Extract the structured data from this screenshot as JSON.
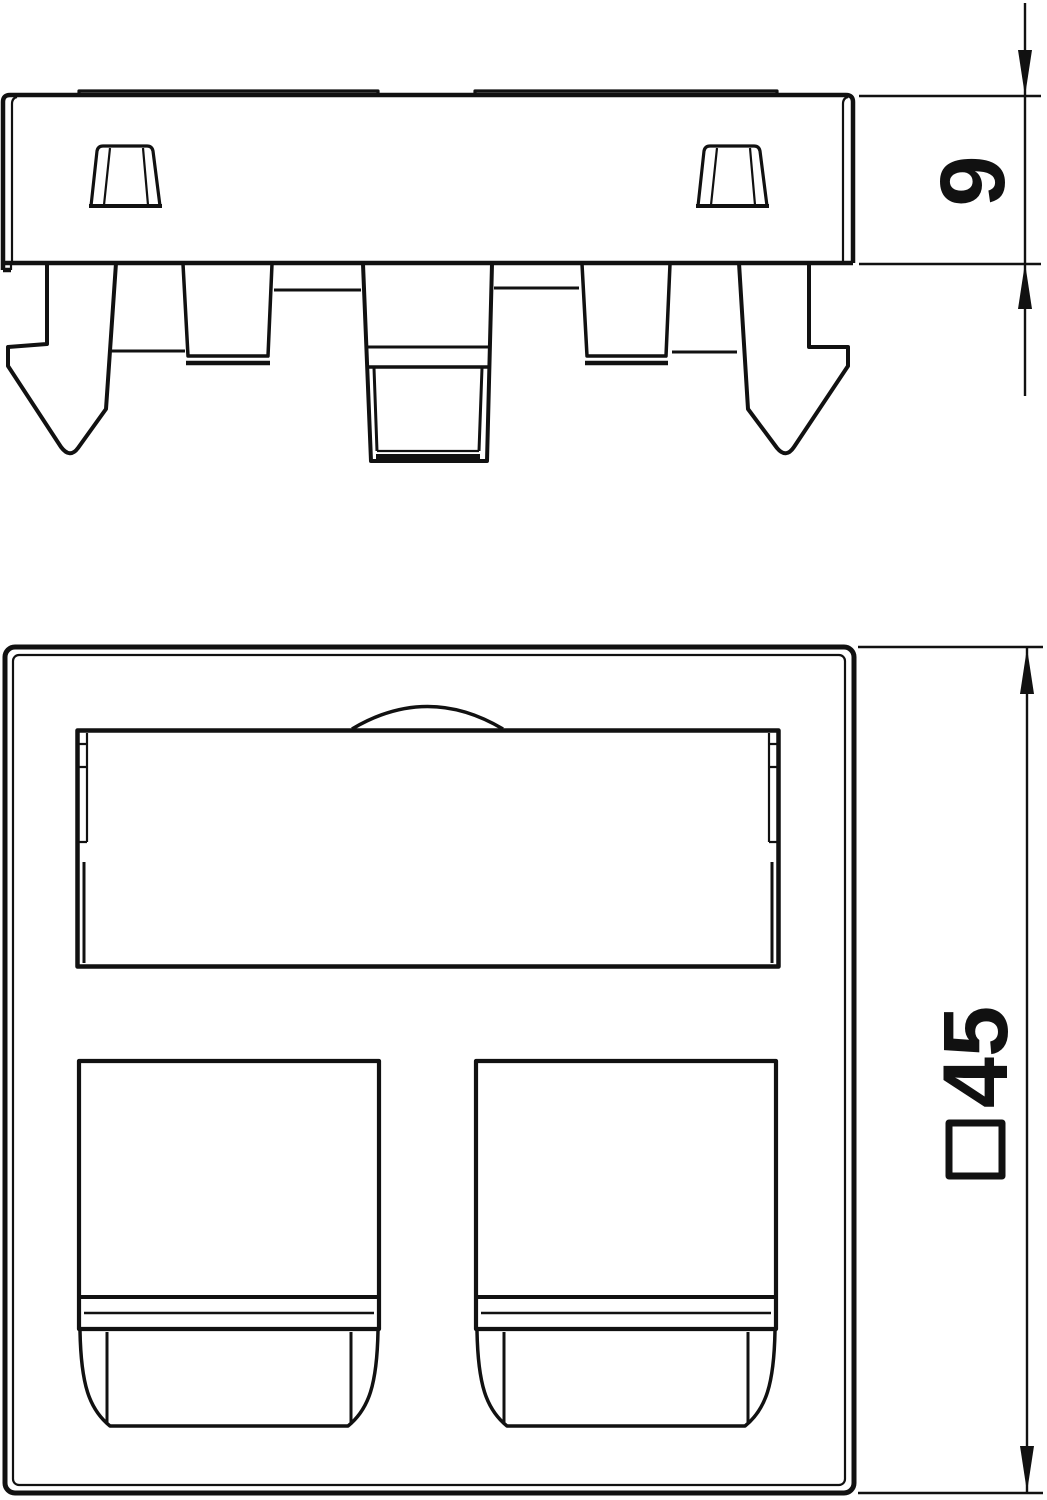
{
  "colors": {
    "background": "#ffffff",
    "line": "#111111"
  },
  "drawing": {
    "views": {
      "side_view": {
        "dimension_depth": {
          "label": "9"
        }
      },
      "front_view": {
        "dimension_size": {
          "label": "45",
          "symbol": "□"
        }
      }
    }
  }
}
